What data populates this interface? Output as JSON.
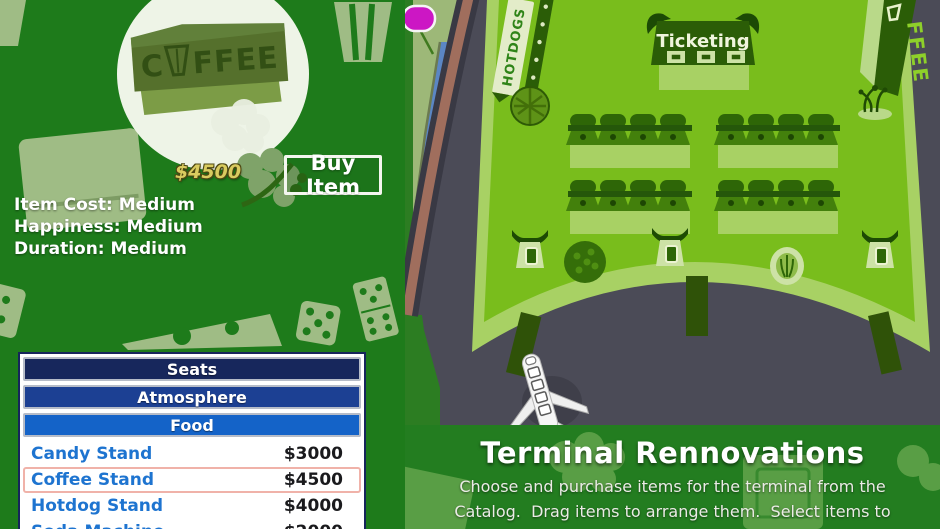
{
  "left_panel": {
    "item_preview": {
      "sign_prefix": "C",
      "sign_suffix": "FFEE",
      "price": "$4500"
    },
    "buy_button_label": "Buy Item",
    "stats": [
      "Item Cost: Medium",
      "Happiness: Medium",
      "Duration: Medium"
    ]
  },
  "catalog": {
    "categories": [
      {
        "label": "Seats",
        "color": "#17275c"
      },
      {
        "label": "Atmosphere",
        "color": "#1c4093"
      },
      {
        "label": "Food",
        "color": "#1463c8"
      }
    ],
    "items": [
      {
        "name": "Candy Stand",
        "price": "$3000",
        "selected": false
      },
      {
        "name": "Coffee Stand",
        "price": "$4500",
        "selected": true
      },
      {
        "name": "Hotdog Stand",
        "price": "$4000",
        "selected": false
      },
      {
        "name": "Soda Machine",
        "price": "$2000",
        "selected": false
      }
    ]
  },
  "terminal": {
    "ticketing_sign": "Ticketing",
    "hotdogs_sign": "HOTDOGS",
    "coffee_banner": "FFEE",
    "seat_row_count": 4,
    "seats_per_row": 4,
    "gate_count": 3,
    "jet_bridge_count": 3
  },
  "info_panel": {
    "title": "Terminal Rennovations",
    "description_lines": [
      "Choose and purchase items for the terminal from the",
      "Catalog.  Drag items to arrange them.  Select items to"
    ]
  },
  "colors": {
    "panel_green": "#1e7b1b",
    "band_green": "#237d20",
    "terminal_floor": "#79bd1c",
    "terminal_band": "#a8d164",
    "tarmac": "#4b4b57",
    "selection_pink": "#f0b2a9",
    "item_name_blue": "#1e74d0",
    "price_gold": "#d9cb5f",
    "map_pin_magenta": "#cc17c4"
  }
}
